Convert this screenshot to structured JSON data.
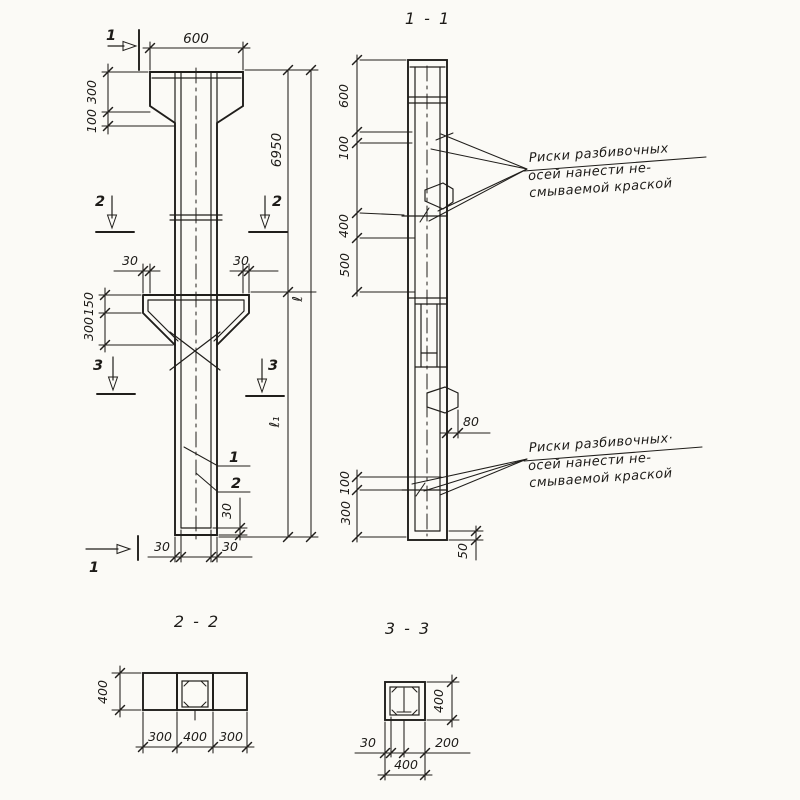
{
  "front_view": {
    "marks": {
      "cut1_top": "1",
      "cut1_bottom": "1",
      "cut2_left": "2",
      "cut2_right": "2",
      "cut3_left": "3",
      "cut3_right": "3"
    },
    "dims": {
      "top_width": "600",
      "cap_height": "300",
      "cap_taper": "100",
      "corbel_left": "30",
      "corbel_right": "30",
      "corbel_face": "150",
      "corbel_slope": "300",
      "upper_length": "6950",
      "total_length": "ℓ",
      "lower_length": "ℓ₁",
      "cover_bottom": "30",
      "cover_base_left": "30",
      "cover_base_right": "30"
    },
    "callouts": {
      "rebar_1": "1",
      "rebar_2": "2"
    }
  },
  "section_1_1": {
    "title": "1 - 1",
    "dims": {
      "d600": "600",
      "d100_top": "100",
      "d400": "400",
      "d500": "500",
      "loop": "80",
      "d100_bottom": "100",
      "d300": "300",
      "cover": "50"
    },
    "note_top": [
      "Риски разбивочных",
      "осей нанести не-",
      "смываемой краской"
    ],
    "note_bottom": [
      "Риски разбивочных·",
      "осей нанести не-",
      "смываемой краской"
    ]
  },
  "section_2_2": {
    "title": "2 - 2",
    "dims": {
      "height": "400",
      "left": "300",
      "middle": "400",
      "right": "300"
    }
  },
  "section_3_3": {
    "title": "3 - 3",
    "dims": {
      "height": "400",
      "cover": "30",
      "half": "200",
      "width": "400"
    }
  }
}
